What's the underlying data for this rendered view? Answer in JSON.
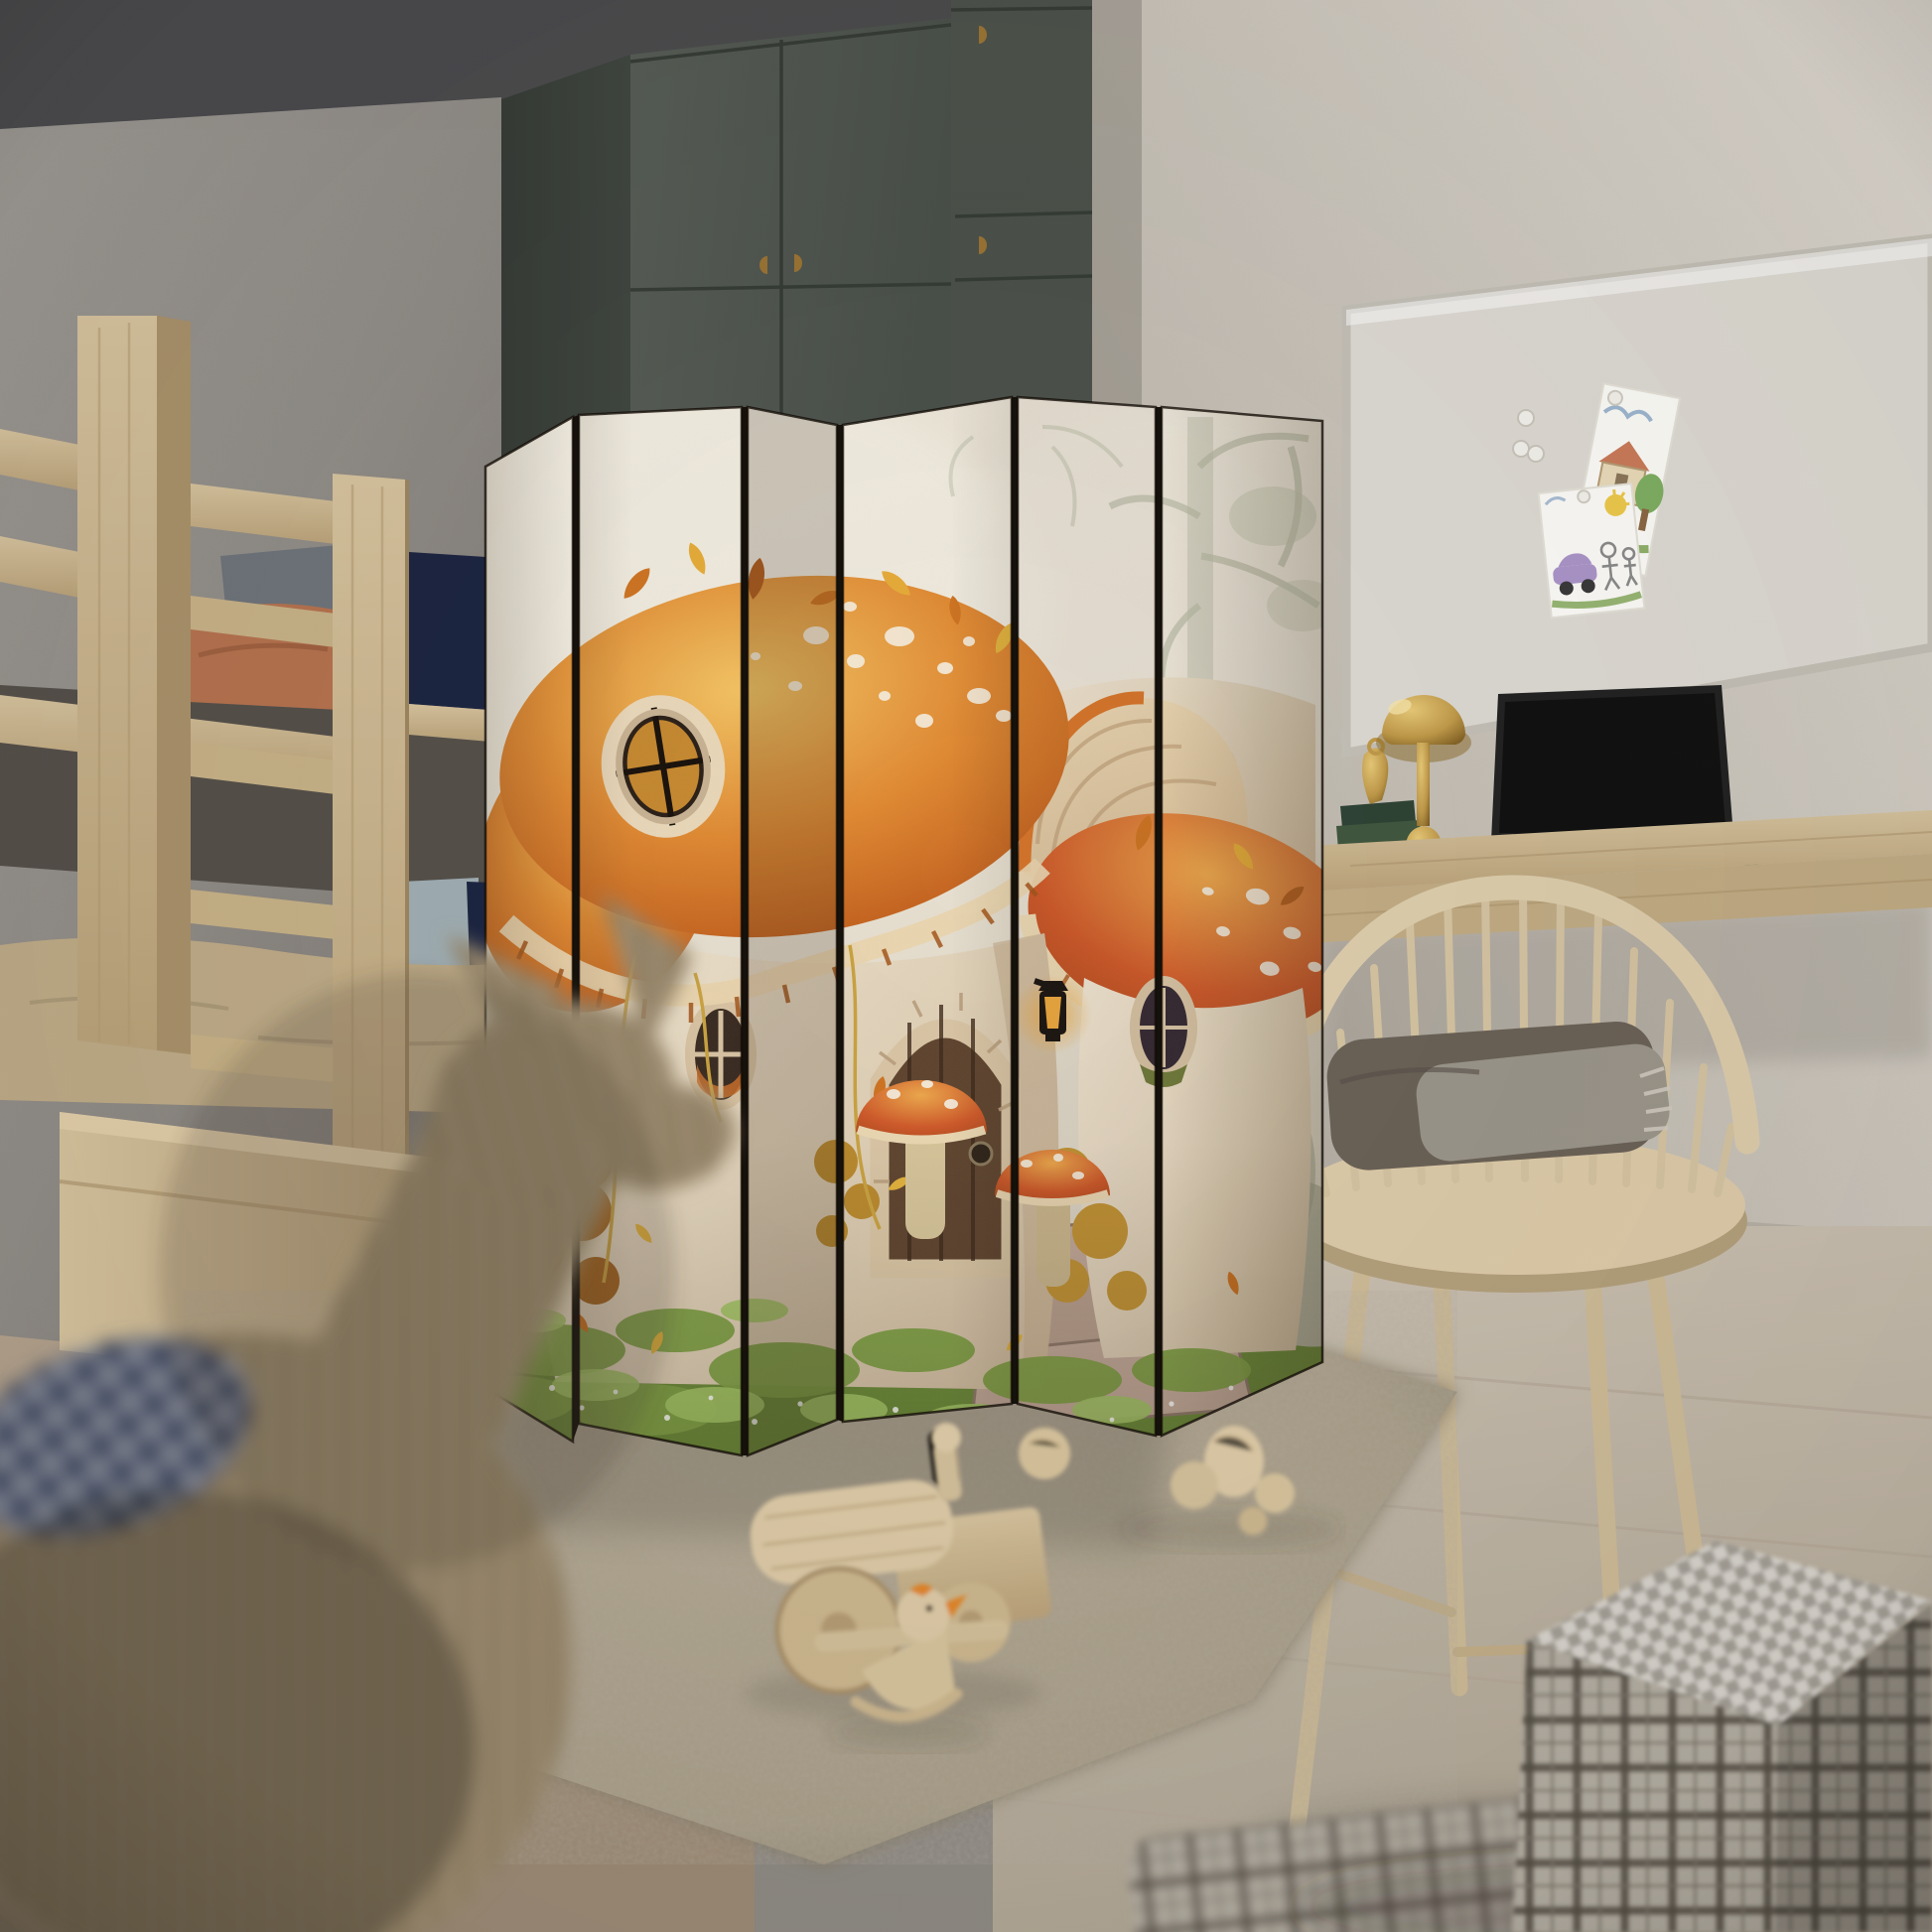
{
  "scene": {
    "type": "photograph",
    "setting": "children's bedroom",
    "objects": [
      {
        "name": "bunk-bed",
        "material": "light ash wood",
        "details": [
          "ladder rungs",
          "terracotta duvet top bunk",
          "grey pillow",
          "navy fabric guard",
          "tan duvet bottom bunk",
          "light-blue pillow",
          "navy cushion",
          "storage platform"
        ]
      },
      {
        "name": "room-divider-screen",
        "panels": 6,
        "artwork": "autumn fairy mushroom house in misty forest",
        "art_elements": [
          "large orange fly-agaric cap with white spots",
          "round amber cap window",
          "cream mushroom house wall",
          "oval stone-framed windows",
          "arched wooden door with stone surround",
          "black lanterns with amber glow",
          "red toadstools",
          "stone steps",
          "green moss with white flowers",
          "orange autumn bushes",
          "golden vines",
          "falling leaves",
          "pale sage misty trees"
        ]
      },
      {
        "name": "wardrobe",
        "color": "grey-green",
        "handles": "brass half-moon"
      },
      {
        "name": "whiteboard",
        "items": [
          "child drawing: house and tree",
          "child drawing: car, stick figures and sun",
          "white magnets"
        ]
      },
      {
        "name": "floating-desk",
        "items": [
          "laptop with dark screen",
          "brass mushroom table lamp",
          "brass figurine",
          "stack of books"
        ]
      },
      {
        "name": "spindle-chair",
        "items": [
          "folded brown blanket",
          "fringed throw"
        ]
      },
      {
        "name": "shag-rug",
        "color": "taupe"
      },
      {
        "name": "wooden-toy-train"
      },
      {
        "name": "wooden-rocking-duck",
        "accent": "orange beak"
      },
      {
        "name": "wooden-balls",
        "count": 5
      },
      {
        "name": "plaid-cube-pouf"
      },
      {
        "name": "wicker-rocking-animal",
        "position": "blurred foreground",
        "contains": "navy plaid blanket"
      }
    ]
  },
  "colors": {
    "ceiling": "#4a4a4d",
    "wallLeft": "#8f8b86",
    "wallRight": "#ddd8d0",
    "wallRightShade": "#a8a29a",
    "wardrobe": "#575d56",
    "wardrobeDark": "#404640",
    "canvas": "#efe9dc",
    "capOrange": "#e08a33",
    "capDeep": "#bf5d1d",
    "capRed": "#cf5a2a",
    "gills": "#d9c09a",
    "houseWall": "#f0e6d2",
    "houseShade": "#d2bfa2",
    "door": "#6b4c31",
    "stone": "#d8c4a4",
    "moss": "#6b8a3a",
    "mossLight": "#a2c465",
    "bushOrange": "#b06a26",
    "leafYellow": "#e2b23c",
    "woodLight": "#d5c29d",
    "woodMid": "#b9a27a",
    "bedNavy": "#1d2642",
    "pillowBlue": "#9fadb2",
    "duvetTan": "#bdaa87",
    "terracotta": "#b4724f",
    "rug": "#a89d88",
    "floorRight": "#ccc2b3",
    "floorLeft": "#b2a18c",
    "brass": "#c09a4a",
    "laptop": "#232323",
    "whiteboard": "#dcd9d2",
    "hinge": "#16120d",
    "lanternGlow": "#eba93f",
    "plaid": "#b3ada2",
    "plaidDark": "#575046",
    "wicker": "#a8977b",
    "navyPlaid": "#26334f"
  }
}
